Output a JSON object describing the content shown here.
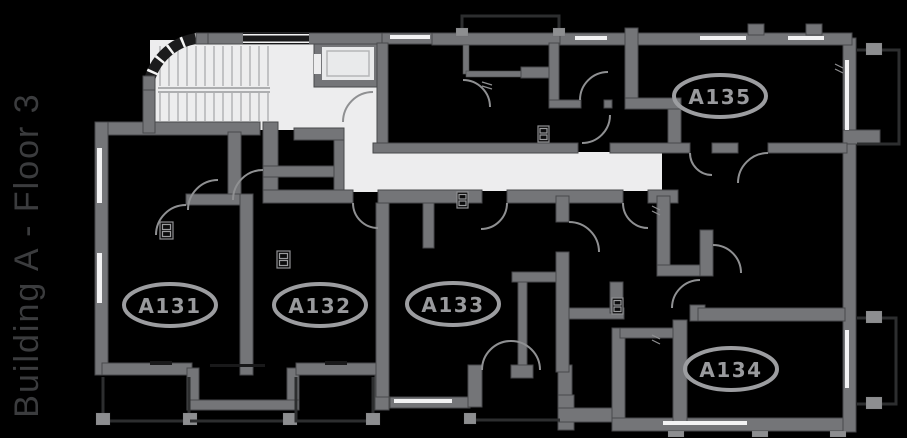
{
  "title": "Building A - Floor 3",
  "plan": {
    "building": "Building A",
    "floor": "Floor 3",
    "units": [
      {
        "id": "A131",
        "label": "A131",
        "cx": 170,
        "cy": 305
      },
      {
        "id": "A132",
        "label": "A132",
        "cx": 320,
        "cy": 305
      },
      {
        "id": "A133",
        "label": "A133",
        "cx": 453,
        "cy": 304
      },
      {
        "id": "A134",
        "label": "A134",
        "cx": 731,
        "cy": 369
      },
      {
        "id": "A135",
        "label": "A135",
        "cx": 720,
        "cy": 96
      }
    ]
  },
  "colors": {
    "bg": "#000000",
    "wall": "#747578",
    "wallEdge": "#48494b",
    "floor": "#ededee",
    "oval": "#9c9da0",
    "ovalText": "#999a9d",
    "title": "#3b3c3e",
    "door": "#8f9092",
    "rail": "#2d2e2f",
    "post": "#8d8e90",
    "window": "#f3f3f4",
    "darkwin": "#19191a",
    "stairs": "#aaabad"
  }
}
